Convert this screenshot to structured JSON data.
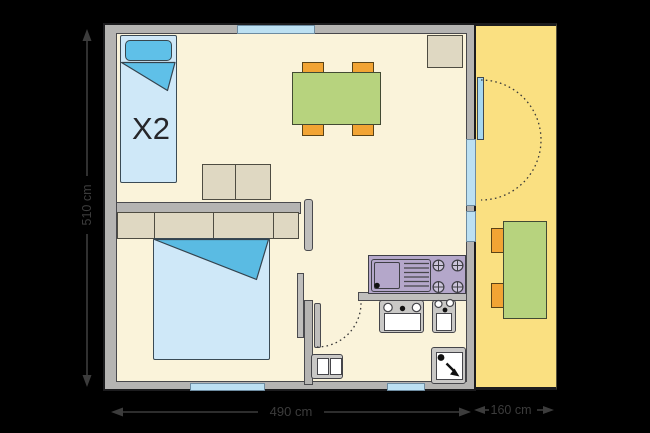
{
  "labels": {
    "bed_multiplier": "X2",
    "dimension_left": "510 cm",
    "dimension_bottom": "490 cm",
    "dimension_terrace": "160 cm"
  },
  "colors": {
    "background": "#000000",
    "interior_floor": "#FAF3DA",
    "terrace_floor": "#FAE081",
    "wall_gray": "#B5B4B2",
    "window_blue": "#BCE0F2",
    "bed_blue": "#CFE8F8",
    "bedding_accent_blue": "#5FC0E8",
    "table_green": "#B7D37E",
    "chair_orange": "#F2A434",
    "kitchen_counter_purple": "#B4A7CA",
    "furniture_beige": "#DFD8C2",
    "dimension_gray": "#3C3C3C"
  },
  "furniture_icons": [
    "single-bed-icon",
    "double-bed-icon",
    "sofa-icon",
    "wardrobe-icon",
    "dining-table-icon",
    "chair-icon",
    "cupboard-icon",
    "kitchen-sink-icon",
    "stove-icon",
    "washbasin-icon",
    "toilet-icon",
    "shower-icon",
    "terrace-table-icon",
    "door-swing-icon",
    "window-icon"
  ]
}
